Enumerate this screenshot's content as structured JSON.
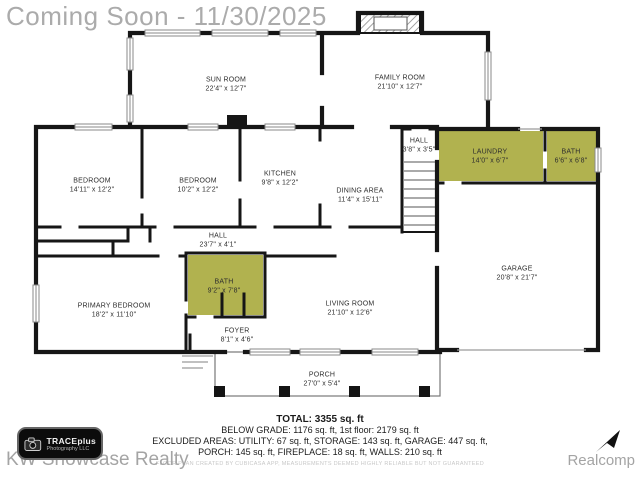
{
  "title": "Coming Soon - 11/30/2025",
  "colors": {
    "wall": "#161616",
    "highlight": "#b1b24f",
    "window_frame": "#8a8a8a",
    "title_gray": "#ababab",
    "watermark_gray": "#a4a4a4"
  },
  "rooms": {
    "sun_room": {
      "name": "SUN ROOM",
      "dims": "22'4\" x 12'7\""
    },
    "family_room": {
      "name": "FAMILY ROOM",
      "dims": "21'10\" x 12'7\""
    },
    "bedroom_1": {
      "name": "BEDROOM",
      "dims": "14'11\" x 12'2\""
    },
    "bedroom_2": {
      "name": "BEDROOM",
      "dims": "10'2\" x 12'2\""
    },
    "kitchen": {
      "name": "KITCHEN",
      "dims": "9'8\" x 12'2\""
    },
    "dining_area": {
      "name": "DINING AREA",
      "dims": "11'4\" x 15'11\""
    },
    "hall_upper": {
      "name": "HALL",
      "dims": "3'8\" x 3'5\""
    },
    "laundry": {
      "name": "LAUNDRY",
      "dims": "14'0\" x 6'7\""
    },
    "bath_upper": {
      "name": "BATH",
      "dims": "6'6\" x 6'8\""
    },
    "hall_main": {
      "name": "HALL",
      "dims": "23'7\" x 4'1\""
    },
    "bath_main": {
      "name": "BATH",
      "dims": "9'2\" x 7'8\""
    },
    "primary_bedroom": {
      "name": "PRIMARY BEDROOM",
      "dims": "18'2\" x 11'10\""
    },
    "foyer": {
      "name": "FOYER",
      "dims": "8'1\" x 4'6\""
    },
    "living_room": {
      "name": "LIVING ROOM",
      "dims": "21'10\" x 12'6\""
    },
    "porch": {
      "name": "PORCH",
      "dims": "27'0\" x 5'4\""
    },
    "garage": {
      "name": "GARAGE",
      "dims": "20'8\" x 21'7\""
    }
  },
  "stats": {
    "total": "TOTAL: 3355 sq. ft",
    "line1": "BELOW GRADE: 1176 sq. ft, 1st floor: 2179 sq. ft",
    "line2": "EXCLUDED AREAS: UTILITY: 67 sq. ft, STORAGE: 143 sq. ft, GARAGE: 447 sq. ft,",
    "line3": "PORCH: 145 sq. ft, FIREPLACE: 18 sq. ft, WALLS: 210 sq. ft",
    "disclaimer": "FLOOR PLAN CREATED BY CUBICASA APP, MEASUREMENTS DEEMED HIGHLY RELIABLE BUT NOT GUARANTEED"
  },
  "branding": {
    "logo_line1": "TRACEplus",
    "logo_line2": "Photography LLC",
    "watermark": "KW Showcase Realty",
    "provider": "Realcomp"
  }
}
